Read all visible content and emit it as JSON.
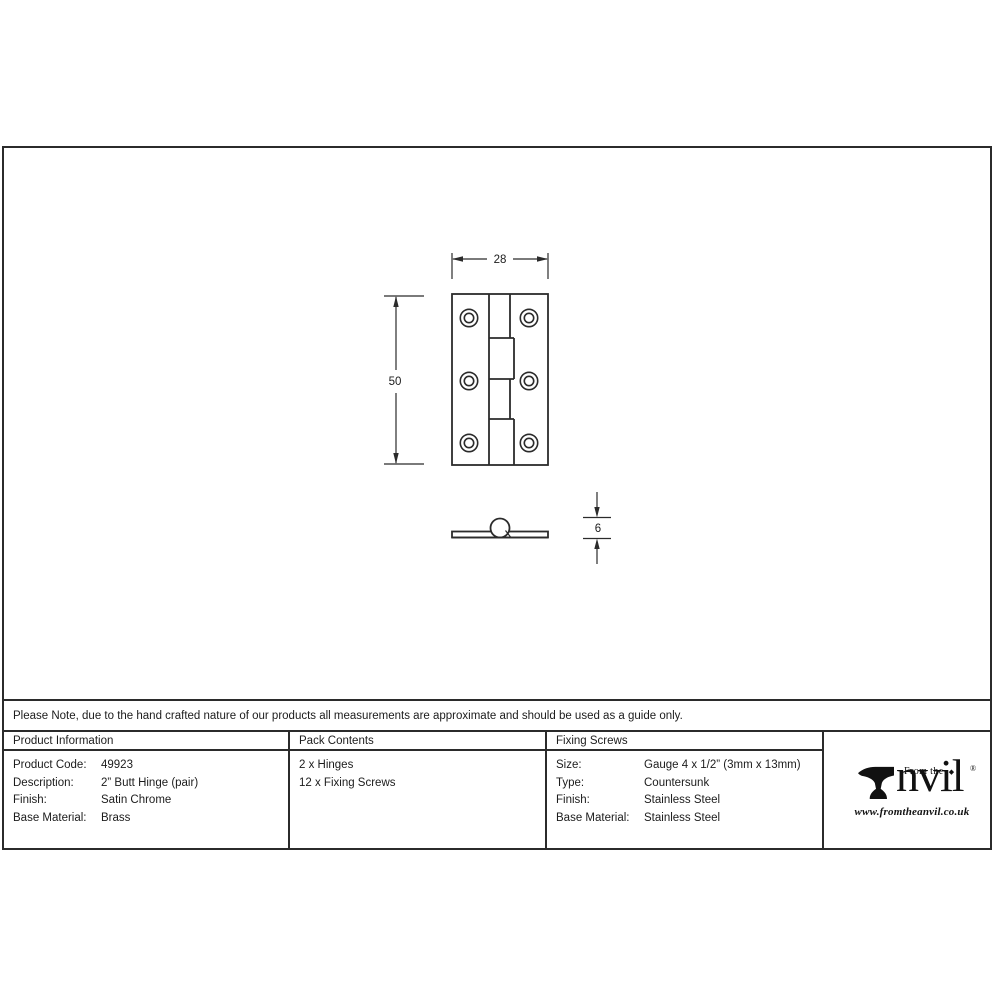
{
  "drawing": {
    "front_view": {
      "width_label": "28",
      "height_label": "50"
    },
    "side_view": {
      "thickness_label": "6"
    }
  },
  "note": "Please Note, due to the hand crafted nature of our products all measurements are approximate and should be used as a guide only.",
  "table": {
    "product_information": {
      "header": "Product Information",
      "rows": [
        {
          "label": "Product Code:",
          "value": "49923"
        },
        {
          "label": "Description:",
          "value": "2” Butt Hinge (pair)"
        },
        {
          "label": "Finish:",
          "value": "Satin Chrome"
        },
        {
          "label": "Base Material:",
          "value": "Brass"
        }
      ]
    },
    "pack_contents": {
      "header": "Pack Contents",
      "items": [
        "2 x Hinges",
        "12 x Fixing Screws"
      ]
    },
    "fixing_screws": {
      "header": "Fixing Screws",
      "rows": [
        {
          "label": "Size:",
          "value": "Gauge 4 x 1/2” (3mm x 13mm)"
        },
        {
          "label": "Type:",
          "value": "Countersunk"
        },
        {
          "label": "Finish:",
          "value": "Stainless Steel"
        },
        {
          "label": "Base Material:",
          "value": "Stainless Steel"
        }
      ]
    }
  },
  "logo": {
    "from_the": "From the",
    "name_rest": "nvil",
    "diamond": "◆",
    "registered": "®",
    "website": "www.fromtheanvil.co.uk"
  },
  "colors": {
    "line": "#2b2b2b",
    "text": "#1c1c1c",
    "background": "#ffffff"
  }
}
